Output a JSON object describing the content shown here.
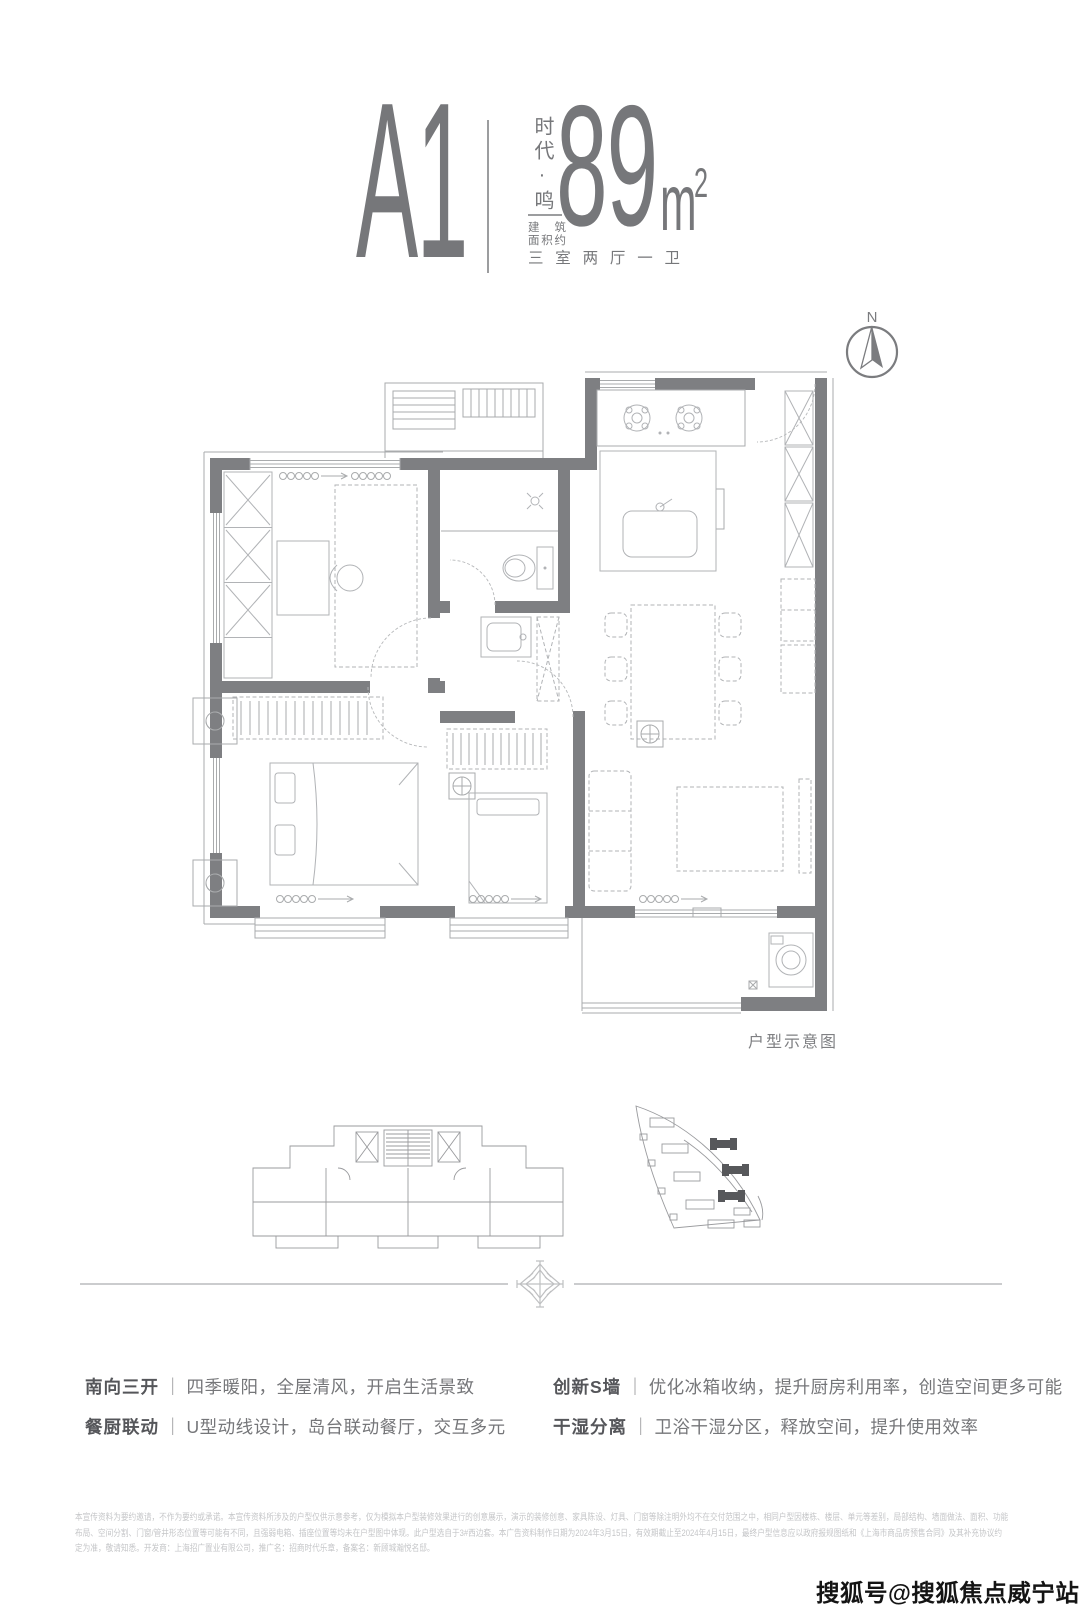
{
  "header": {
    "unit_code": "A1",
    "project_name_vertical": "时代·鸣",
    "area_prefix_top": "建 筑",
    "area_prefix_bottom": "面积约",
    "area_number": "89",
    "area_unit": "m",
    "area_unit_exp": "2",
    "layout_type": "三室两厅一卫"
  },
  "compass": {
    "north_label": "N"
  },
  "plan": {
    "caption": "户型示意图"
  },
  "features": {
    "separator": "｜",
    "items": [
      {
        "label": "南向三开",
        "desc": "四季暖阳，全屋清风，开启生活景致"
      },
      {
        "label": "餐厨联动",
        "desc": "U型动线设计，岛台联动餐厅，交互多元"
      },
      {
        "label": "创新S墙",
        "desc": "优化冰箱收纳，提升厨房利用率，创造空间更多可能"
      },
      {
        "label": "干湿分离",
        "desc": "卫浴干湿分区，释放空间，提升使用效率"
      }
    ]
  },
  "disclaimer": {
    "line1": "本宣传资料为要约邀请，不作为要约或承诺。本宣传资料所涉及的户型仅供示意参考，仅为模拟本户型装修效果进行的创意展示，演示的装修创意、家具陈设、灯具、门窗等除注明外均不在交付范围之中，相同户型因楼栋、楼层、单元等差别，局部结构、墙面做法、面积、功能",
    "line2": "布局、空间分割、门窗/管井形态位置等可能有不同，且强弱电箱、插座位置等均未在户型图中体现。此户型选自于3#西边套。本广告资料制作日期为2024年3月15日，有效期截止至2024年4月15日，最终户型信息应以政府报规图纸和《上海市商品房预售合同》及其补充协议约",
    "line3": "定为准，敬请知悉。开发商：上海招广置业有限公司，推广名：招商时代乐章，备案名：新顾城瀚悦名邸。"
  },
  "watermark": "搜狐号@搜狐焦点威宁站",
  "colors": {
    "primary_gray": "#76777a",
    "wall_gray": "#7e7f82",
    "line_light": "#a9abad",
    "divider": "#cbccce"
  }
}
